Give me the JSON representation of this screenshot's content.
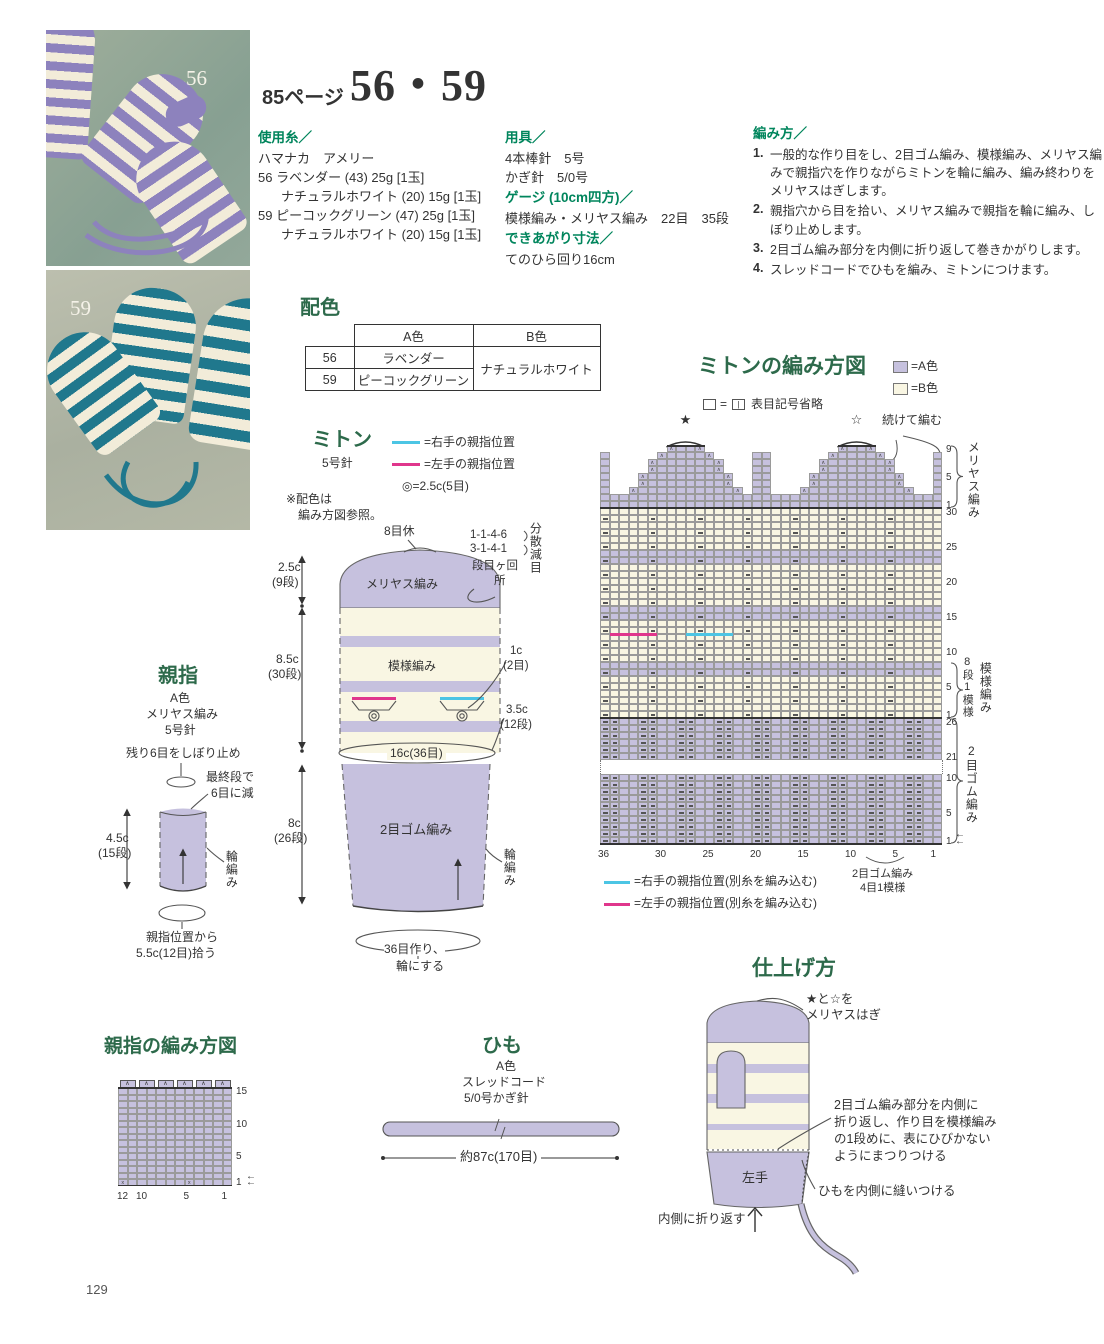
{
  "page": {
    "number": "129"
  },
  "header": {
    "page_ref": "85ページ",
    "title": "56・59"
  },
  "photos": [
    {
      "label": "56"
    },
    {
      "label": "59"
    }
  ],
  "yarn": {
    "heading": "使用糸／",
    "maker": "ハマナカ　アメリー",
    "items": [
      {
        "no": "56",
        "text": "ラベンダー (43) 25g [1玉]"
      },
      {
        "no": "",
        "text": "ナチュラルホワイト (20) 15g [1玉]"
      },
      {
        "no": "59",
        "text": "ピーコックグリーン (47) 25g [1玉]"
      },
      {
        "no": "",
        "text": "ナチュラルホワイト (20) 15g [1玉]"
      }
    ]
  },
  "tools": {
    "heading": "用具／",
    "line1": "4本棒針　5号",
    "line2": "かぎ針　5/0号",
    "gauge_heading": "ゲージ (10cm四方)／",
    "gauge_line": "模様編み・メリヤス編み　22目　35段",
    "size_heading": "できあがり寸法／",
    "size_line": "てのひら回り16cm"
  },
  "howto": {
    "heading": "編み方／",
    "steps": [
      {
        "no": "1.",
        "text": "一般的な作り目をし、2目ゴム編み、模様編み、メリヤス編みで親指穴を作りながらミトンを輪に編み、編み終わりをメリヤスはぎします。"
      },
      {
        "no": "2.",
        "text": "親指穴から目を拾い、メリヤス編みで親指を輪に編み、しぼり止めします。"
      },
      {
        "no": "3.",
        "text": "2目ゴム編み部分を内側に折り返して巻きかがりします。"
      },
      {
        "no": "4.",
        "text": "スレッドコードでひもを編み、ミトンにつけます。"
      }
    ]
  },
  "color_table": {
    "heading": "配色",
    "col_a": "A色",
    "col_b": "B色",
    "row1_no": "56",
    "row1_a": "ラベンダー",
    "row2_no": "59",
    "row2_a": "ピーコックグリーン",
    "b_value": "ナチュラルホワイト"
  },
  "mitten": {
    "title": "ミトン",
    "needle": "5号針",
    "legend_right": "=右手の親指位置",
    "legend_left": "=左手の親指位置",
    "legend_circle": "◎=2.5c(5目)",
    "note1": "※配色は",
    "note2": "編み方図参照。",
    "rest": "8目休",
    "dome": "メリヤス編み",
    "body": "模様編み",
    "rib": "2目ゴム編み",
    "dim1a": "2.5c",
    "dim1b": "(9段)",
    "dim2a": "8.5c",
    "dim2b": "(30段)",
    "dim3a": "8c",
    "dim3b": "(26段)",
    "dec_line1": "1-1-4-6",
    "dec_line2": "3-1-4-1",
    "dec_unit1": "段目ヶ回",
    "dec_unit2": "所",
    "dec_label": "分散減目",
    "t1a": "1c",
    "t1b": "(2目)",
    "t2a": "3.5c",
    "t2b": "(12段)",
    "width_label": "16c(36目)",
    "ring": "輪編み",
    "cast1": "36目作り、",
    "cast2": "輪にする"
  },
  "thumb": {
    "title": "親指",
    "color": "A色",
    "stitch": "メリヤス編み",
    "needle": "5号針",
    "bindoff": "残り6目をしぼり止め",
    "dec1": "最終段で",
    "dec2": "6目に減",
    "dima": "4.5c",
    "dimb": "(15段)",
    "ring": "輪編み",
    "pick1": "親指位置から",
    "pick2": "5.5c(12目)拾う"
  },
  "mitten_chart": {
    "title": "ミトンの編み方図",
    "legend_a": "=A色",
    "legend_b": "=B色",
    "symbol_eq": "=",
    "symbol_knit": "|",
    "symbol_note": "表目記号省略",
    "star1": "★",
    "star2": "☆",
    "cont": "続けて編む",
    "side_top": "メリヤス編み",
    "side_mid1": "8段1模様",
    "side_mid2": "模様編み",
    "side_bot": "2目ゴム編み",
    "legend_right": "=右手の親指位置(別糸を編み込む)",
    "legend_left": "=左手の親指位置(別糸を編み込む)",
    "bracket1": "2目ゴム編み",
    "bracket2": "4目1模様"
  },
  "thumb_chart_labels": {
    "title": "親指の編み方図"
  },
  "cord": {
    "title": "ひも",
    "color": "A色",
    "type": "スレッドコード",
    "needle": "5/0号かぎ針",
    "length": "約87c(170目)"
  },
  "finishing": {
    "title": "仕上げ方",
    "graft1": "★と☆を",
    "graft2": "メリヤスはぎ",
    "sew1": "2目ゴム編み部分を内側に",
    "sew2": "折り返し、作り目を模様編み",
    "sew3": "の1段めに、表にひびかない",
    "sew4": "ようにまつりつける",
    "cord_note": "ひもを内側に縫いつける",
    "fold": "内側に折り返す",
    "hand": "左手"
  },
  "colors": {
    "purple": "#c6c1de",
    "cream": "#f9f6e3",
    "pink": "#e0368c",
    "cyan": "#4cc5e4",
    "green": "#00855c",
    "title_green": "#2d6a4b",
    "grid": "#9a9a9a",
    "photo_purple": "#8d82bd",
    "photo_teal": "#20788d",
    "photo_cream": "#f2ecd9"
  },
  "chart_data": [
    {
      "id": "mitten_chart",
      "type": "knitting-grid",
      "stitches": 36,
      "cell_w": 9.5,
      "cell_h": 7,
      "origin_x": 600,
      "origin_y": 445,
      "sections": [
        {
          "kind": "rib",
          "rows": 10,
          "row_start": 1,
          "right_labels": [
            [
              10,
              "10"
            ],
            [
              5,
              "5"
            ],
            [
              1,
              "1"
            ]
          ],
          "arrow_rows": [
            1,
            2
          ]
        },
        {
          "kind": "gap",
          "height": 14
        },
        {
          "kind": "rib",
          "rows": 6,
          "row_start": 21,
          "right_labels": [
            [
              26,
              "26"
            ],
            [
              21,
              "21"
            ]
          ]
        },
        {
          "kind": "body",
          "rows": 30,
          "row_start": 1,
          "stripe_rows": [
            7,
            8,
            15,
            16,
            23,
            24
          ],
          "dash_stitches": [
            36,
            31,
            26,
            21,
            16,
            11,
            6
          ],
          "right_labels": [
            [
              30,
              "30"
            ],
            [
              25,
              "25"
            ],
            [
              20,
              "20"
            ],
            [
              15,
              "15"
            ],
            [
              10,
              "10"
            ],
            [
              5,
              "5"
            ],
            [
              1,
              "1"
            ]
          ],
          "thumb_markers": [
            {
              "color": "pink",
              "hi": 35,
              "lo": 31,
              "row": 12
            },
            {
              "color": "cyan",
              "hi": 27,
              "lo": 23,
              "row": 12
            }
          ]
        },
        {
          "kind": "top",
          "rows": 9,
          "row_start": 1,
          "full_rows": [
            1,
            2
          ],
          "strips": [
            [
              36,
              36
            ],
            [
              20,
              19
            ],
            [
              1,
              1
            ]
          ],
          "strip_rows": [
            3,
            8
          ],
          "pyramids": [
            {
              "top_hi": 29,
              "top_lo": 26
            },
            {
              "top_hi": 11,
              "top_lo": 8
            }
          ],
          "expand": [
            4,
            3,
            3,
            2,
            2,
            1,
            0
          ],
          "right_labels": [
            [
              9,
              "9"
            ],
            [
              5,
              "5"
            ],
            [
              1,
              "1"
            ]
          ]
        }
      ],
      "x_labels": [
        [
          36,
          "36"
        ],
        [
          30,
          "30"
        ],
        [
          25,
          "25"
        ],
        [
          20,
          "20"
        ],
        [
          15,
          "15"
        ],
        [
          10,
          "10"
        ],
        [
          5,
          "5"
        ],
        [
          1,
          "1"
        ]
      ],
      "bottom_bracket_stitches": [
        8,
        5
      ],
      "notes": {
        "rib_repeat": "2目ゴム編み4目1模様",
        "pattern_repeat": "8段1模様",
        "gauge": "22目35段/10cm"
      }
    },
    {
      "id": "thumb_chart",
      "type": "knitting-grid",
      "stitches": 12,
      "rows": 15,
      "cell_w": 9.5,
      "cell_h": 6.5,
      "origin_x": 118,
      "origin_y": 1088,
      "right_labels": [
        [
          15,
          "15"
        ],
        [
          10,
          "10"
        ],
        [
          5,
          "5"
        ],
        [
          1,
          "1"
        ]
      ],
      "arrow_rows": [
        1,
        2
      ],
      "x_labels": [
        [
          12,
          "12"
        ],
        [
          10,
          "10"
        ],
        [
          5,
          "5"
        ],
        [
          1,
          "1"
        ]
      ],
      "top_dec_pairs": [
        [
          12,
          11
        ],
        [
          10,
          9
        ],
        [
          8,
          7
        ],
        [
          6,
          5
        ],
        [
          4,
          3
        ],
        [
          2,
          1
        ]
      ],
      "twist_stitches": [
        12,
        5
      ]
    }
  ]
}
